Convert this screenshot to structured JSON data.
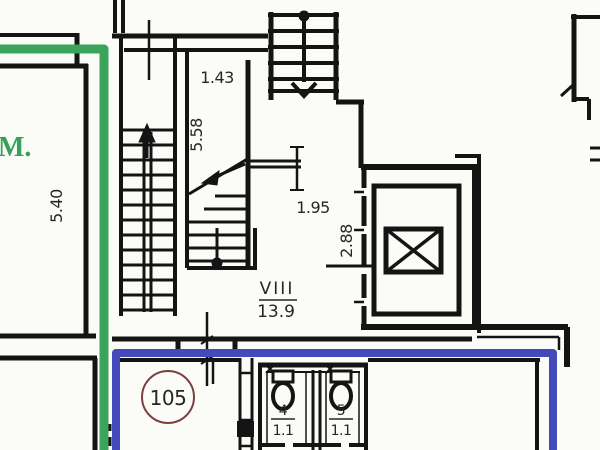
{
  "labels": {
    "green_region": "М.",
    "dim_left_room": "5.40",
    "dim_stair_width": "1.43",
    "dim_stair_height": "5.58",
    "dim_lobby": "1.95",
    "dim_elevator": "2.88",
    "stairwell_number": "VIII",
    "stairwell_area": "13.9",
    "apartment_number": "105",
    "wc_left_number": "4",
    "wc_left_area": "1.1",
    "wc_right_number": "5",
    "wc_right_area": "1.1"
  },
  "colors": {
    "wall": "#141414",
    "green_line": "#3aa55a",
    "blue_line": "#4449bb",
    "room_circle_stroke": "#7b4040",
    "background": "#fbfbf8",
    "text": "#262626"
  }
}
